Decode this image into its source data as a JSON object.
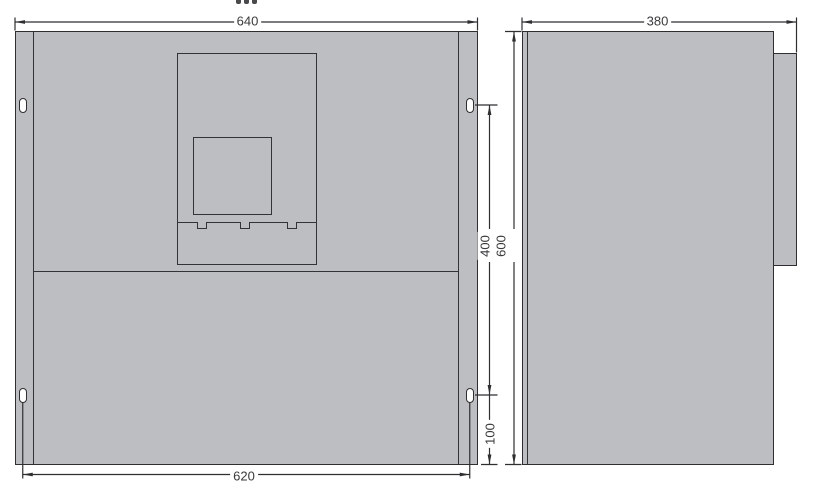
{
  "drawing": {
    "type": "technical-dimension-drawing",
    "views": [
      "front",
      "side"
    ],
    "colors": {
      "body_fill": "#bdbec2",
      "line": "#2f2f31",
      "dim_text": "#3a3a3c",
      "background": "#ffffff",
      "slot_fill": "#ffffff"
    },
    "front_view": {
      "dimensions": {
        "overall_width": "640",
        "slot_spacing_horizontal": "620",
        "slot_spacing_vertical": "400",
        "slot_bottom_offset": "100"
      }
    },
    "side_view": {
      "dimensions": {
        "depth": "380",
        "overall_height": "600"
      }
    }
  }
}
